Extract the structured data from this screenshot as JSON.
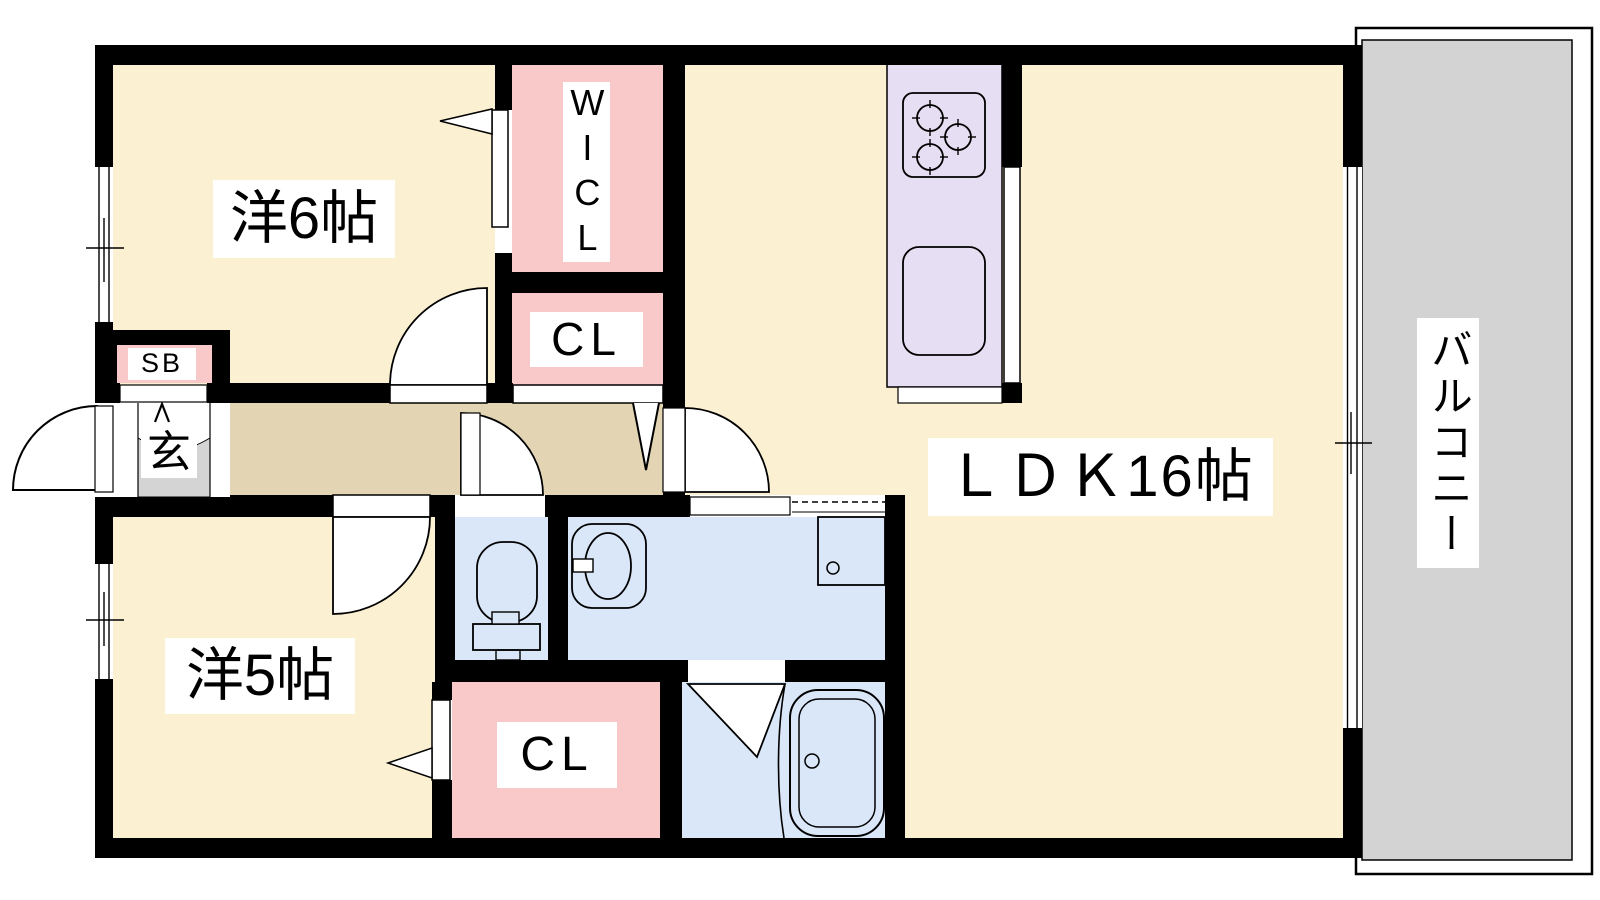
{
  "plan": {
    "type": "apartment-floor-plan",
    "rooms": {
      "western6": {
        "label": "洋6帖"
      },
      "western5": {
        "label": "洋5帖"
      },
      "ldk": {
        "label": "ＬＤＫ16帖"
      },
      "wicl": {
        "label": "WICL"
      },
      "closet_upper": {
        "label": "CL"
      },
      "closet_lower": {
        "label": "CL"
      },
      "shoe_box": {
        "label": "SB"
      },
      "entrance": {
        "label": "玄"
      },
      "balcony": {
        "label": "バルコニー"
      }
    },
    "colors": {
      "room_cream": "#FBF0D1",
      "hallway_tan": "#E3D4B4",
      "closet_pink": "#F9C9C9",
      "kitchen_lavender": "#E6DEF2",
      "water_blue": "#D9E7F8",
      "balcony_gray": "#D3D3D3",
      "entrance_gray": "#D4D4D4",
      "wall": "#000000",
      "background": "#FFFFFF"
    }
  }
}
